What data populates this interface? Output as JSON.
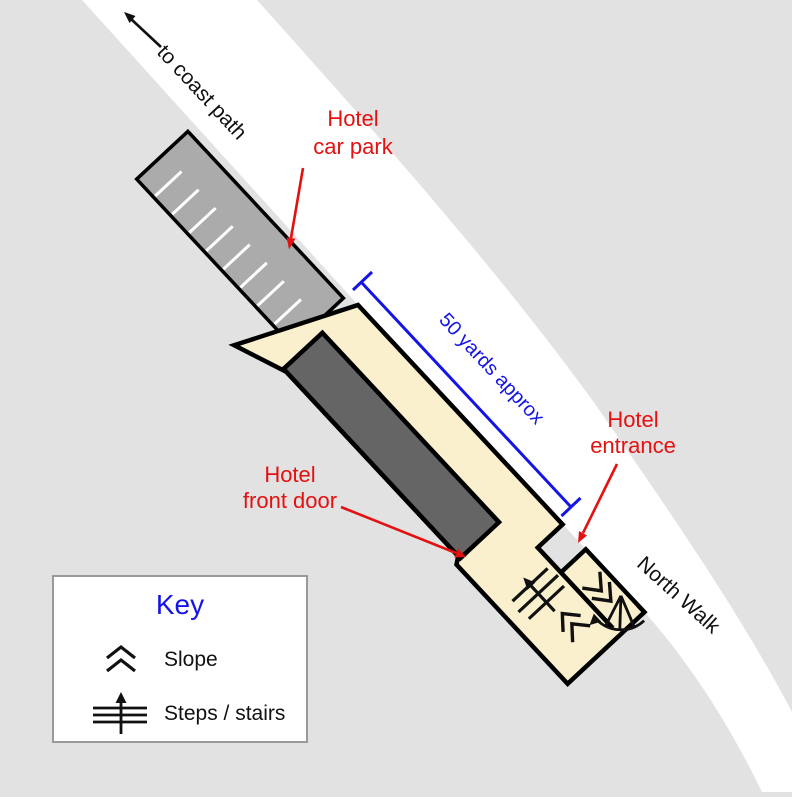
{
  "map_labels": {
    "coast_path": "to coast path",
    "north_walk": "North Walk",
    "distance": "50 yards approx",
    "car_park": [
      "Hotel",
      "car park"
    ],
    "entrance": [
      "Hotel",
      "entrance"
    ],
    "front_door": [
      "Hotel",
      "front door"
    ]
  },
  "key": {
    "title": "Key",
    "items": [
      {
        "icon": "slope-icon",
        "label": "Slope"
      },
      {
        "icon": "steps-icon",
        "label": "Steps / stairs"
      }
    ]
  },
  "map_symbols": {
    "corridor_slope": "slope-icon",
    "lower_wing_slope": "slope-icon",
    "interior_steps": "steps-icon",
    "corner_stairs": "curved-stairs-icon",
    "coast_direction": "arrow-up-left-icon"
  },
  "colors": {
    "background": "#e2e2e2",
    "road": "#ffffff",
    "car_park": "#ababab",
    "plot": "#faf0cd",
    "building": "#656565",
    "label_red": "#e41111",
    "measure_blue": "#1414e6",
    "outline": "#000000",
    "key_border": "#999999"
  }
}
